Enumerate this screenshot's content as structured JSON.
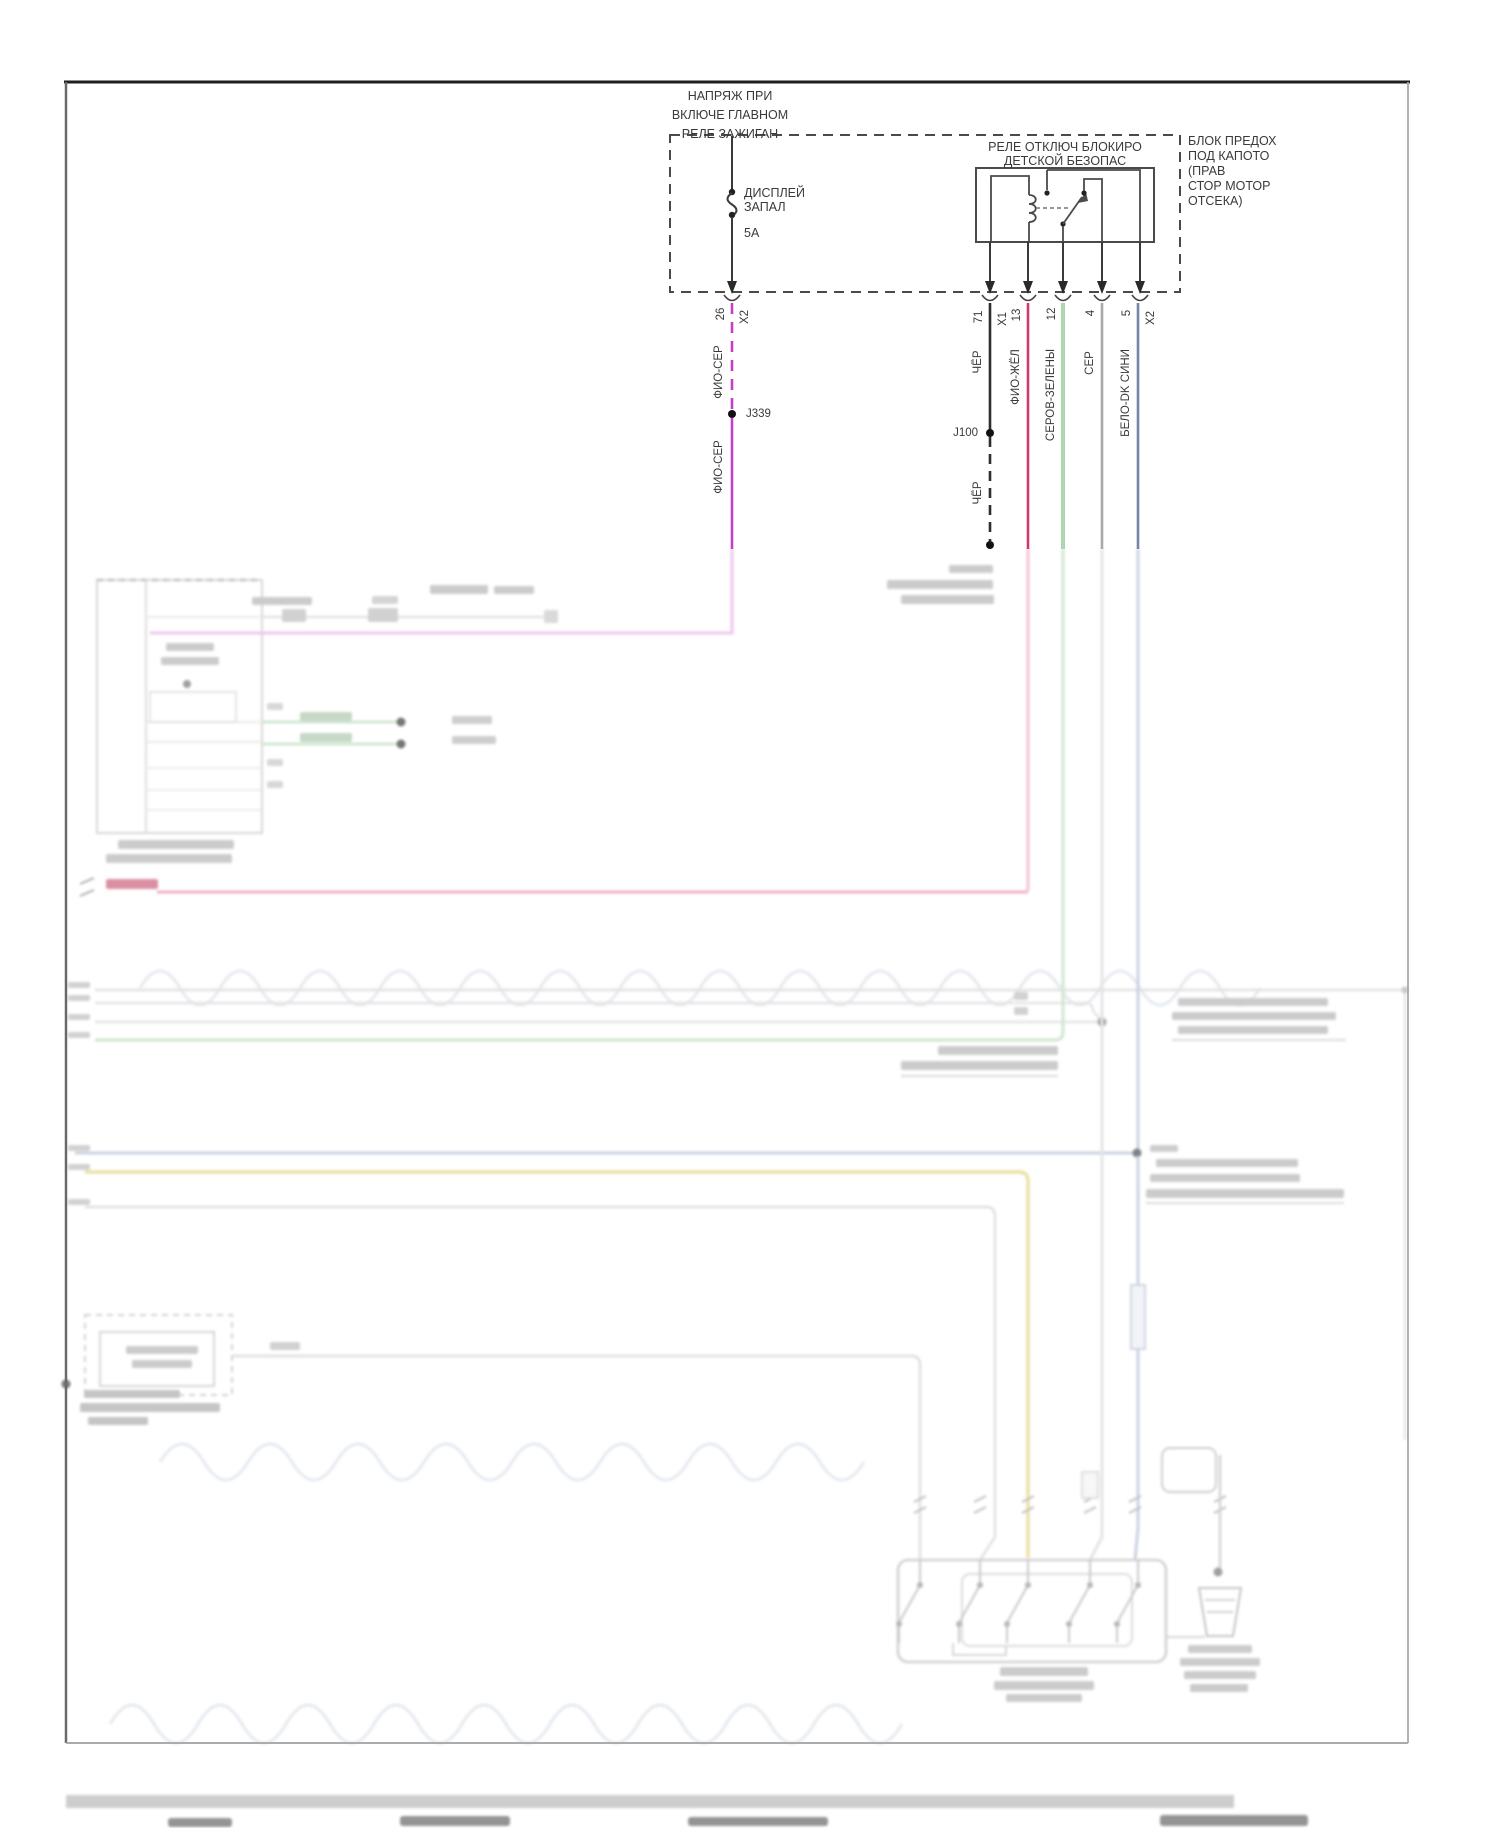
{
  "diagram": {
    "note": [
      "НАПРЯЖ ПРИ",
      "ВКЛЮЧЕ ГЛАВНОМ",
      "РЕЛЕ ЗАЖИГАН"
    ],
    "fuse": {
      "line1": "ДИСПЛЕЙ",
      "line2": "ЗАПАЛ",
      "rating": "5А"
    },
    "relay": [
      "РЕЛЕ ОТКЛЮЧ БЛОКИРО",
      "ДЕТСКОЙ БЕЗОПАС"
    ],
    "block": [
      "БЛОК ПРЕДОХ",
      "ПОД КАПОТО",
      "(ПРАВ",
      "СТОР МОТОР",
      "ОТСЕКА)"
    ],
    "wires": [
      {
        "pin": "26",
        "conn": "X2",
        "label_upper": "ФИО-СЕР",
        "junction": "J339",
        "label_lower": "ФИО-СЕР",
        "color": "#c33fc6"
      },
      {
        "pin": "71",
        "conn": "X1",
        "label_upper": "ЧЁР",
        "junction": "J100",
        "label_lower": "ЧЁР",
        "color": "#2d2d2d"
      },
      {
        "pin": "13",
        "label_upper": "ФИО-ЖЁЛ",
        "color": "#ce3a69"
      },
      {
        "pin": "12",
        "label_upper": "СЕРОВ-ЗЕЛЕНЫ",
        "color": "#74b478"
      },
      {
        "pin": "4",
        "label_upper": "СЕР",
        "color": "#a8a8a8"
      },
      {
        "pin": "5",
        "conn": "X2",
        "label_upper": "БЕЛО-DK СИНИ",
        "color": "#7286a6"
      }
    ],
    "faded": {
      "magenta": "#ecc4ed",
      "crimson": "#f3c0cf",
      "red_line": "#efaebf",
      "red_label": "#d98a9e",
      "green": "#cfe6cf",
      "yellow": "#e9df9e",
      "blue": "#c7cfe0",
      "gray_line": "#dedede",
      "text_bar": "#c9c9c9",
      "watermark": "#e3e9f0"
    }
  }
}
